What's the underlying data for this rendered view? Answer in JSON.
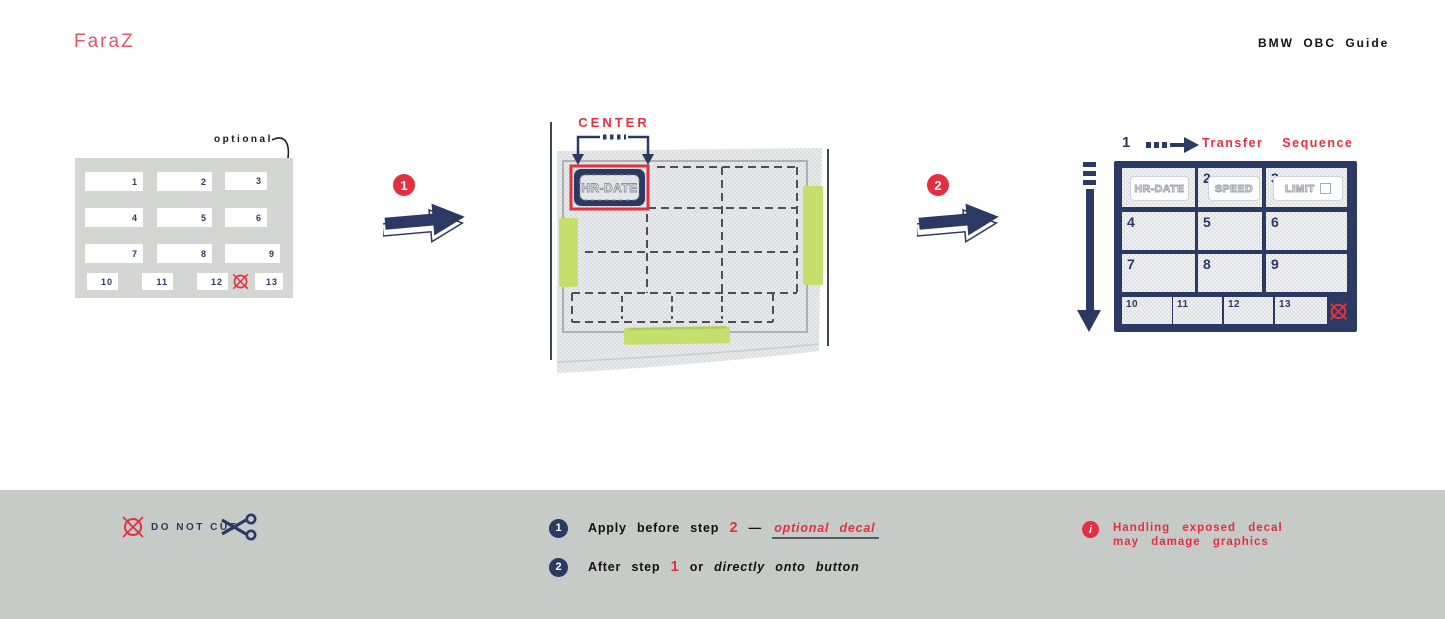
{
  "colors": {
    "navy": "#2b3a62",
    "red": "#e42f41",
    "logo_red": "#e25562",
    "tape_green": "#c4df6b",
    "panel_gray": "#d3d6d2",
    "footer_gray": "#c6cbc7"
  },
  "header": {
    "logo": "FaraZ",
    "title": "BMW OBC Guide"
  },
  "left_panel": {
    "optional_label": "optional",
    "cells": [
      {
        "label": "1"
      },
      {
        "label": "2"
      },
      {
        "label": "3"
      },
      {
        "label": "4"
      },
      {
        "label": "5"
      },
      {
        "label": "6"
      },
      {
        "label": "7"
      },
      {
        "label": "8"
      },
      {
        "label": "9"
      },
      {
        "label": "10"
      },
      {
        "label": "11"
      },
      {
        "label": "12"
      },
      {
        "label": "13"
      }
    ]
  },
  "steps": {
    "step1_badge": "1",
    "step2_badge": "2"
  },
  "center_diagram": {
    "center_label": "CENTER",
    "decal_label": "HR-DATE"
  },
  "transfer_panel": {
    "step_number": "1",
    "title": "Transfer Sequence",
    "row1": [
      {
        "number": "",
        "button": "HR-DATE"
      },
      {
        "number": "2",
        "button": "SPEED"
      },
      {
        "number": "3",
        "button": "LIMIT"
      }
    ],
    "cells": [
      {
        "label": "4"
      },
      {
        "label": "5"
      },
      {
        "label": "6"
      },
      {
        "label": "7"
      },
      {
        "label": "8"
      },
      {
        "label": "9"
      }
    ],
    "small_cells": [
      {
        "label": "10"
      },
      {
        "label": "11"
      },
      {
        "label": "12"
      },
      {
        "label": "13"
      }
    ]
  },
  "footer": {
    "do_not_cut": "DO NOT CUT",
    "legend1": {
      "badge": "1",
      "text": "Apply before step",
      "step_ref": "2",
      "dash": "—",
      "emphasis": "optional decal"
    },
    "legend2": {
      "badge": "2",
      "text": "After step",
      "step_ref": "1",
      "connector": "or",
      "emphasis": "directly onto button"
    },
    "warning": {
      "icon": "i",
      "line1": "Handling exposed decal",
      "line2": "may damage graphics"
    }
  }
}
